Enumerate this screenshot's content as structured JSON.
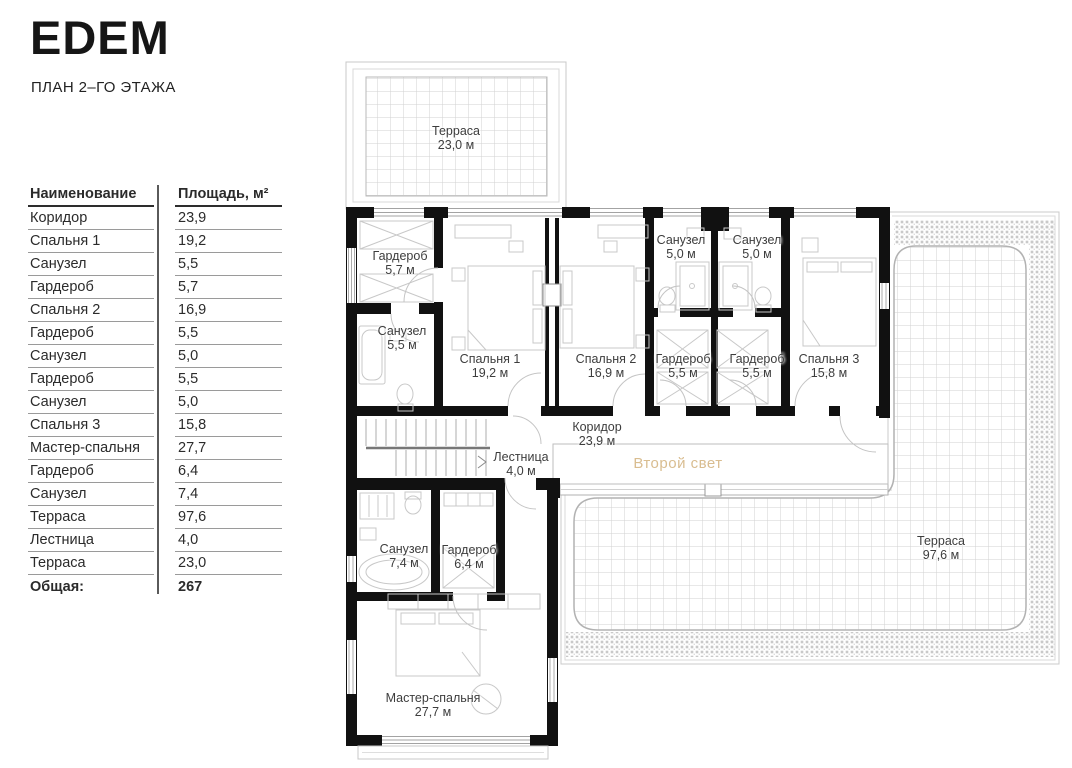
{
  "header": {
    "logo": "EDEM",
    "subtitle": "ПЛАН 2–ГО ЭТАЖА"
  },
  "table": {
    "columns": {
      "name": "Наименование",
      "area": "Площадь, м²"
    },
    "rows": [
      {
        "name": "Коридор",
        "area": "23,9"
      },
      {
        "name": "Спальня 1",
        "area": "19,2"
      },
      {
        "name": "Санузел",
        "area": "5,5"
      },
      {
        "name": "Гардероб",
        "area": "5,7"
      },
      {
        "name": "Спальня 2",
        "area": "16,9"
      },
      {
        "name": "Гардероб",
        "area": "5,5"
      },
      {
        "name": "Санузел",
        "area": "5,0"
      },
      {
        "name": "Гардероб",
        "area": "5,5"
      },
      {
        "name": "Санузел",
        "area": "5,0"
      },
      {
        "name": "Спальня 3",
        "area": "15,8"
      },
      {
        "name": "Мастер-спальня",
        "area": "27,7"
      },
      {
        "name": "Гардероб",
        "area": "6,4"
      },
      {
        "name": "Санузел",
        "area": "7,4"
      },
      {
        "name": "Терраса",
        "area": "97,6"
      },
      {
        "name": "Лестница",
        "area": "4,0"
      },
      {
        "name": "Терраса",
        "area": "23,0"
      }
    ],
    "total": {
      "name": "Общая:",
      "area": "267"
    }
  },
  "plan": {
    "labels": [
      {
        "key": "terrace-top",
        "name": "Терраса",
        "area": "23,0 м",
        "x": 456,
        "y": 138
      },
      {
        "key": "wardrobe-5-7",
        "name": "Гардероб",
        "area": "5,7 м",
        "x": 400,
        "y": 263
      },
      {
        "key": "bathroom-5-5",
        "name": "Санузел",
        "area": "5,5 м",
        "x": 402,
        "y": 338
      },
      {
        "key": "bedroom-1",
        "name": "Спальня 1",
        "area": "19,2 м",
        "x": 490,
        "y": 366
      },
      {
        "key": "bedroom-2",
        "name": "Спальня 2",
        "area": "16,9 м",
        "x": 606,
        "y": 366
      },
      {
        "key": "bathroom-5-0-left",
        "name": "Санузел",
        "area": "5,0 м",
        "x": 681,
        "y": 247
      },
      {
        "key": "bathroom-5-0-right",
        "name": "Санузел",
        "area": "5,0 м",
        "x": 757,
        "y": 247
      },
      {
        "key": "wardrobe-5-5-left",
        "name": "Гардероб",
        "area": "5,5 м",
        "x": 683,
        "y": 366
      },
      {
        "key": "wardrobe-5-5-right",
        "name": "Гардероб",
        "area": "5,5 м",
        "x": 757,
        "y": 366
      },
      {
        "key": "bedroom-3",
        "name": "Спальня 3",
        "area": "15,8 м",
        "x": 829,
        "y": 366
      },
      {
        "key": "corridor",
        "name": "Коридор",
        "area": "23,9 м",
        "x": 597,
        "y": 434
      },
      {
        "key": "stairs",
        "name": "Лестница",
        "area": "4,0 м",
        "x": 521,
        "y": 464
      },
      {
        "key": "second-light",
        "name": "Второй свет",
        "area": "",
        "x": 678,
        "y": 464,
        "color": "#d9bd90",
        "single": true
      },
      {
        "key": "bathroom-7-4",
        "name": "Санузел",
        "area": "7,4 м",
        "x": 404,
        "y": 556
      },
      {
        "key": "wardrobe-6-4",
        "name": "Гардероб",
        "area": "6,4 м",
        "x": 469,
        "y": 557
      },
      {
        "key": "master-bedroom",
        "name": "Мастер-спальня",
        "area": "27,7 м",
        "x": 433,
        "y": 705
      },
      {
        "key": "terrace-main",
        "name": "Терраса",
        "area": "97,6 м",
        "x": 941,
        "y": 548
      }
    ]
  },
  "colors": {
    "wall": "#111111",
    "thin_line": "#c8c8c8",
    "grid": "#d2d2d2",
    "text": "#3d3d3d",
    "accent_gold": "#d9bd90"
  }
}
